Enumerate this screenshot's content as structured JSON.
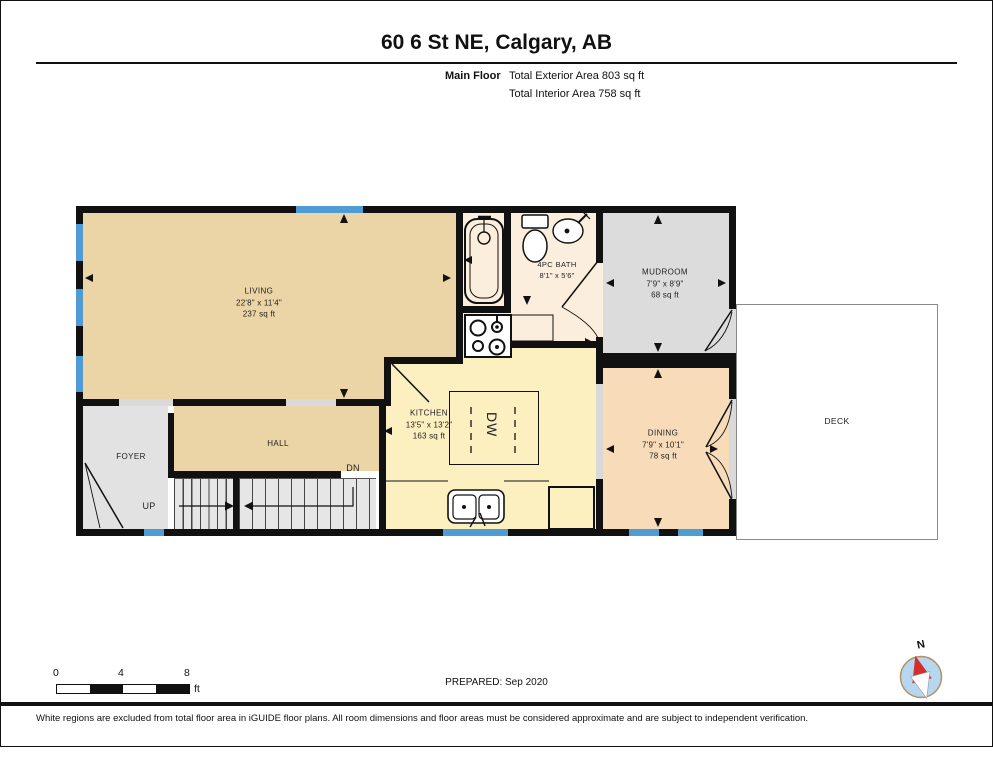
{
  "page": {
    "title": "60 6 St NE, Calgary, AB",
    "floor_label": "Main Floor",
    "exterior_area": "Total Exterior Area 803 sq ft",
    "interior_area": "Total Interior Area 758 sq ft",
    "prepared": "PREPARED: Sep 2020",
    "disclaimer": "White regions are excluded from total floor area in iGUIDE floor plans. All room dimensions and floor areas must be considered approximate and are subject to independent verification."
  },
  "scale_bar": {
    "ticks": [
      "0",
      "4",
      "8"
    ],
    "unit": "ft"
  },
  "compass": {
    "label": "N"
  },
  "rooms": {
    "living": {
      "name": "LIVING",
      "dims": "22'8\" x 11'4\"",
      "area": "237 sq ft"
    },
    "kitchen": {
      "name": "KITCHEN",
      "dims": "13'5\" x 13'2\"",
      "area": "163 sq ft"
    },
    "bath": {
      "name": "4PC BATH",
      "dims": "8'1\" x 5'6\""
    },
    "mudroom": {
      "name": "MUDROOM",
      "dims": "7'9\" x 8'9\"",
      "area": "68 sq ft"
    },
    "dining": {
      "name": "DINING",
      "dims": "7'9\" x 10'1\"",
      "area": "78 sq ft"
    },
    "hall": {
      "name": "HALL"
    },
    "foyer": {
      "name": "FOYER"
    },
    "deck": {
      "name": "DECK"
    },
    "stairs_up": "UP",
    "stairs_down": "DN",
    "dishwasher": "DW"
  },
  "colors": {
    "wall": "#111111",
    "window": "#4f9bd3",
    "living_fill": "#ebd4a5",
    "kitchen_fill": "#fcefc0",
    "bath_fill": "#fbeedd",
    "dining_fill": "#f8dcba",
    "mudroom_fill": "#dcdcdc",
    "compass_blue": "#b5d7ef",
    "compass_red": "#d32f2f"
  }
}
